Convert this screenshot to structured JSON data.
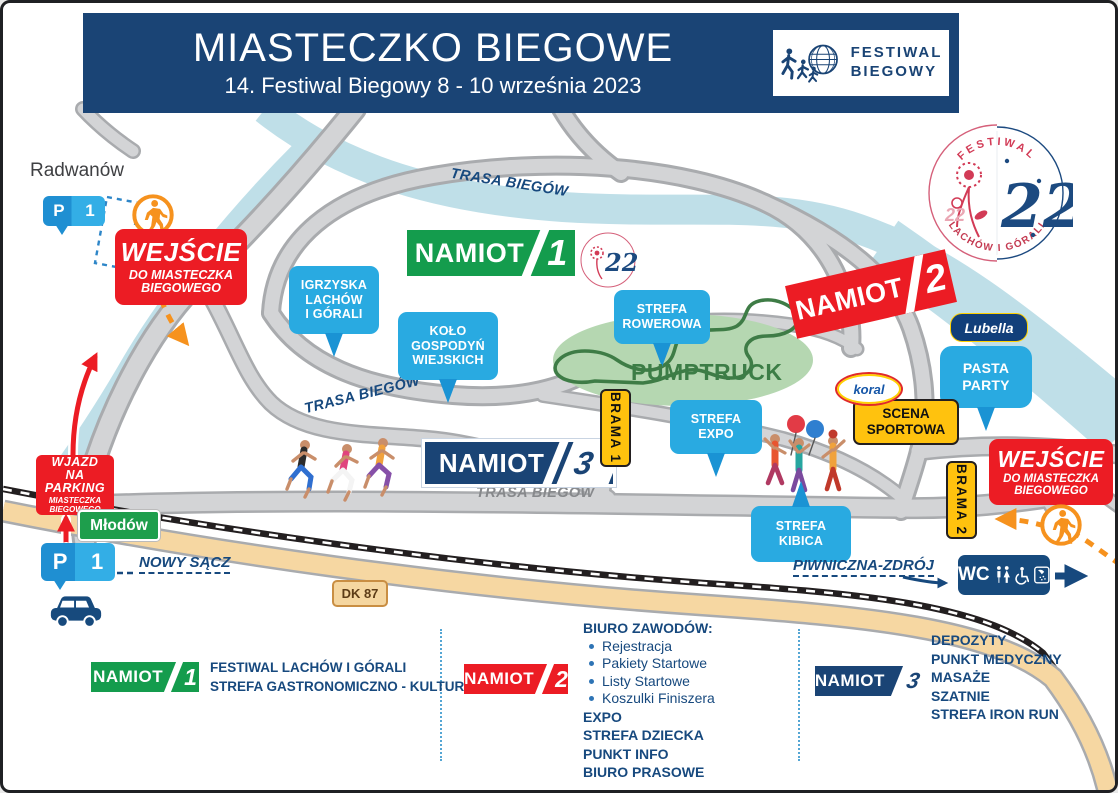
{
  "header": {
    "title": "MIASTECZKO BIEGOWE",
    "subtitle": "14. Festiwal Biegowy 8 - 10 września 2023"
  },
  "brand": {
    "line1": "FESTIWAL",
    "line2": "BIEGOWY"
  },
  "festival_logo": {
    "arc_top": "FESTIWAL",
    "arc_bottom": "LACHÓW I GÓRALI",
    "number": "22"
  },
  "places": {
    "radwanow": "Radwanów",
    "mlodow": "Młodów",
    "poprad": "Poprad"
  },
  "parking": {
    "p": "P",
    "n": "1"
  },
  "entrance": {
    "line1": "WEJŚCIE",
    "line2": "DO MIASTECZKA",
    "line3": "BIEGOWEGO"
  },
  "wjazd": {
    "line1": "WJAZD",
    "line2": "NA PARKING",
    "line3": "MIASTECZKA",
    "line4": "BIEGOWEGO"
  },
  "namiot": {
    "label": "NAMIOT",
    "n1": "1",
    "n2": "2",
    "n3": "3"
  },
  "pins": {
    "igrzyska": [
      "IGRZYSKA",
      "LACHÓW",
      "I GÓRALI"
    ],
    "kolo": [
      "KOŁO",
      "GOSPODYŃ",
      "WIEJSKICH"
    ],
    "rowerowa": [
      "STREFA",
      "ROWEROWA"
    ],
    "expo": [
      "STREFA",
      "EXPO"
    ],
    "kibica": [
      "STREFA",
      "KIBICA"
    ],
    "pasta": [
      "PASTA",
      "PARTY"
    ]
  },
  "areas": {
    "pumptruck": "PUMPTRUCK"
  },
  "gates": {
    "brama1": "BRAMA 1",
    "brama2": "BRAMA 2"
  },
  "stage": {
    "line1": "SCENA",
    "line2": "SPORTOWA"
  },
  "sponsors": {
    "koral": "koral",
    "lubella": "Lubella"
  },
  "route_label": "TRASA BIEGÓW",
  "directions": {
    "west": "NOWY SĄCZ",
    "east": "PIWNICZNA-ZDRÓJ"
  },
  "road": "DK 87",
  "wc": "WC",
  "legend": {
    "n1_lines": [
      "FESTIWAL LACHÓW I GÓRALI",
      "STREFA GASTRONOMICZNO - KULTURALNA"
    ],
    "n2_title": "BIURO ZAWODÓW:",
    "n2_bullets": [
      "Rejestracja",
      "Pakiety Startowe",
      "Listy Startowe",
      "Koszulki Finiszera"
    ],
    "n2_bold": [
      "EXPO",
      "STREFA DZIECKA",
      "PUNKT INFO",
      "BIURO PRASOWE"
    ],
    "n3_lines": [
      "DEPOZYTY",
      "PUNKT MEDYCZNY",
      "MASAŻE",
      "SZATNIE",
      "STREFA IRON RUN"
    ]
  },
  "colors": {
    "navy": "#1a4475",
    "red": "#ec1c24",
    "green": "#149c4d",
    "pin_blue": "#29aae1",
    "yellow": "#ffc20e",
    "river": "#bfdfe8",
    "road": "#d3d4d6",
    "dk87_tan": "#f6d7a2"
  }
}
